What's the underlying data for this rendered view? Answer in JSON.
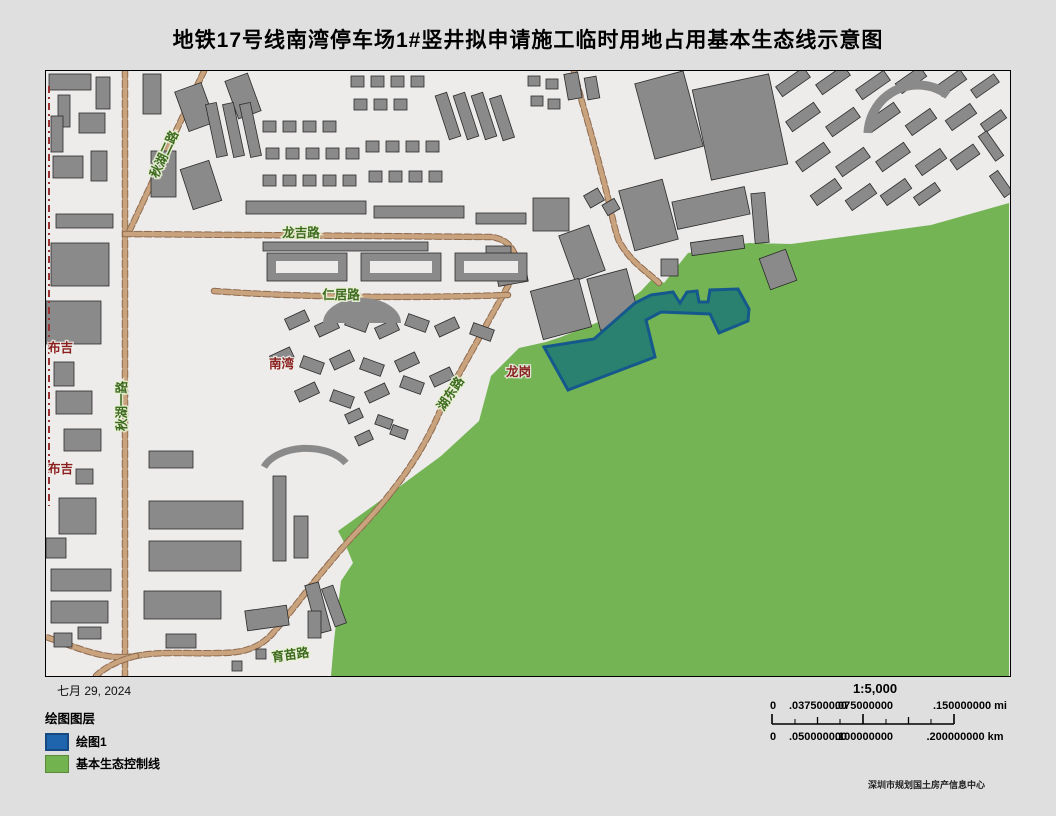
{
  "title": "地铁17号线南湾停车场1#竖井拟申请施工临时用地占用基本生态线示意图",
  "date_text": "七月 29, 2024",
  "attribution": "深圳市规划国土房产信息中心",
  "legend": {
    "title": "绘图图层",
    "items": [
      {
        "label": "绘图1",
        "color": "#1f65ae"
      },
      {
        "label": "基本生态控制线",
        "color": "#72b24f"
      }
    ]
  },
  "scalebar": {
    "ratio": "1:5,000",
    "mi_labels": [
      "0",
      ".037500000",
      ".075000000",
      ".150000000 mi"
    ],
    "km_labels": [
      "0",
      ".050000000",
      ".100000000",
      ".200000000 km"
    ]
  },
  "colors": {
    "page_bg": "#dfdfdf",
    "map_bg": "#edeceb",
    "eco_green": "#74b455",
    "plot_fill": "#2a8170",
    "plot_border": "#15588c",
    "road": "#c9a37d",
    "road_casing": "#8f6a4e",
    "building": "#8a8a8a",
    "building_outline": "#2b2b2b",
    "boundary_red": "#9a3434",
    "road_label_green": "#3c6b1d",
    "place_label_red": "#8b1f1f"
  },
  "map": {
    "labels": {
      "qiuhu2": "秋湖二路",
      "longji": "龙吉路",
      "renju": "仁居路",
      "qiuhu1": "秋湖一路",
      "hudong": "湖东路",
      "yumiao": "育苗路",
      "buji_north": "布吉",
      "buji_south": "布吉",
      "nanwan": "南湾",
      "longgang": "龙岗"
    },
    "green_polygon": "963,132 885,154 745,173 703,172 655,180 642,182 618,212 608,206 595,220 555,250 515,266 500,271 473,277 460,290 445,305 433,350 395,385 338,427 292,460 300,475 307,492 295,510 288,570 285,605 963,605",
    "plot_polygon": "498,276 548,268 589,232 605,224 627,221 634,232 641,221 651,220 653,231 662,231 664,219 692,218 703,238 702,250 673,262 664,243 615,241 600,249 609,286 522,319",
    "boundary_line": "M3,15 L3,435",
    "roads": [
      "M79,0 L79,605",
      "M158,0 L82,163",
      "M79,163 L445,166 C463,168 470,180 472,197",
      "M472,197 L398,330 C380,378 350,420 307,465 C275,500 250,535 227,562 C213,578 195,582 175,582 C140,583 115,580 90,585 C60,590 35,578 0,566",
      "M90,585 C70,590 57,598 50,605",
      "M168,220 C260,227 380,227 462,224",
      "M528,0 C535,30 545,60 555,100 C565,135 567,155 573,170 C585,192 603,202 613,212"
    ],
    "buildings": [
      [
        3,
        3,
        42,
        16,
        0
      ],
      [
        12,
        24,
        12,
        32,
        0
      ],
      [
        50,
        6,
        14,
        32,
        0
      ],
      [
        5,
        45,
        12,
        36,
        0
      ],
      [
        33,
        42,
        26,
        20,
        0
      ],
      [
        7,
        85,
        30,
        22,
        0
      ],
      [
        45,
        80,
        16,
        30,
        0
      ],
      [
        10,
        143,
        57,
        14,
        0
      ],
      [
        5,
        172,
        58,
        43,
        0
      ],
      [
        0,
        230,
        55,
        43,
        0
      ],
      [
        8,
        291,
        20,
        24,
        0
      ],
      [
        10,
        320,
        36,
        23,
        0
      ],
      [
        18,
        358,
        37,
        22,
        0
      ],
      [
        30,
        398,
        17,
        15,
        0
      ],
      [
        13,
        427,
        37,
        36,
        0
      ],
      [
        0,
        467,
        20,
        20,
        0
      ],
      [
        5,
        498,
        60,
        22,
        0
      ],
      [
        5,
        530,
        57,
        22,
        0
      ],
      [
        32,
        556,
        23,
        12,
        0
      ],
      [
        8,
        562,
        18,
        14,
        0
      ],
      [
        103,
        380,
        44,
        17,
        0
      ],
      [
        103,
        430,
        94,
        28,
        0
      ],
      [
        103,
        470,
        92,
        30,
        0
      ],
      [
        98,
        520,
        77,
        28,
        0
      ],
      [
        120,
        563,
        30,
        14,
        0
      ],
      [
        227,
        405,
        13,
        85,
        0
      ],
      [
        248,
        445,
        14,
        42,
        0
      ],
      [
        200,
        537,
        42,
        20,
        -8
      ],
      [
        265,
        512,
        14,
        50,
        -15
      ],
      [
        282,
        515,
        12,
        40,
        -20
      ],
      [
        262,
        540,
        13,
        27,
        0
      ],
      [
        210,
        578,
        10,
        10,
        0
      ],
      [
        186,
        590,
        10,
        10,
        0
      ],
      [
        97,
        3,
        18,
        40,
        0
      ],
      [
        135,
        15,
        28,
        42,
        -20
      ],
      [
        185,
        5,
        24,
        40,
        -20
      ],
      [
        105,
        80,
        25,
        46,
        0
      ],
      [
        140,
        93,
        30,
        42,
        -18
      ],
      [
        165,
        32,
        11,
        54,
        -12
      ],
      [
        182,
        32,
        11,
        54,
        -12
      ],
      [
        199,
        32,
        11,
        54,
        -12
      ],
      [
        217,
        50,
        13,
        11,
        0
      ],
      [
        237,
        50,
        13,
        11,
        0
      ],
      [
        257,
        50,
        13,
        11,
        0
      ],
      [
        277,
        50,
        13,
        11,
        0
      ],
      [
        220,
        77,
        13,
        11,
        0
      ],
      [
        240,
        77,
        13,
        11,
        0
      ],
      [
        260,
        77,
        13,
        11,
        0
      ],
      [
        280,
        77,
        13,
        11,
        0
      ],
      [
        300,
        77,
        13,
        11,
        0
      ],
      [
        217,
        104,
        13,
        11,
        0
      ],
      [
        237,
        104,
        13,
        11,
        0
      ],
      [
        257,
        104,
        13,
        11,
        0
      ],
      [
        277,
        104,
        13,
        11,
        0
      ],
      [
        297,
        104,
        13,
        11,
        0
      ],
      [
        320,
        70,
        13,
        11,
        0
      ],
      [
        340,
        70,
        13,
        11,
        0
      ],
      [
        360,
        70,
        13,
        11,
        0
      ],
      [
        380,
        70,
        13,
        11,
        0
      ],
      [
        323,
        100,
        13,
        11,
        0
      ],
      [
        343,
        100,
        13,
        11,
        0
      ],
      [
        363,
        100,
        13,
        11,
        0
      ],
      [
        383,
        100,
        13,
        11,
        0
      ],
      [
        396,
        22,
        12,
        46,
        -18
      ],
      [
        414,
        22,
        12,
        46,
        -18
      ],
      [
        432,
        22,
        12,
        46,
        -18
      ],
      [
        450,
        25,
        12,
        44,
        -18
      ],
      [
        482,
        5,
        12,
        10,
        0
      ],
      [
        500,
        8,
        12,
        10,
        0
      ],
      [
        485,
        25,
        12,
        10,
        0
      ],
      [
        502,
        28,
        12,
        10,
        0
      ],
      [
        520,
        2,
        14,
        26,
        -10
      ],
      [
        540,
        6,
        12,
        22,
        -10
      ],
      [
        305,
        5,
        13,
        11,
        0
      ],
      [
        325,
        5,
        13,
        11,
        0
      ],
      [
        345,
        5,
        13,
        11,
        0
      ],
      [
        365,
        5,
        13,
        11,
        0
      ],
      [
        308,
        28,
        13,
        11,
        0
      ],
      [
        328,
        28,
        13,
        11,
        0
      ],
      [
        348,
        28,
        13,
        11,
        0
      ],
      [
        200,
        130,
        120,
        13,
        0
      ],
      [
        328,
        135,
        90,
        12,
        0
      ],
      [
        430,
        142,
        50,
        11,
        0
      ],
      [
        217,
        171,
        165,
        9,
        0
      ],
      [
        240,
        243,
        22,
        12,
        -25
      ],
      [
        270,
        250,
        22,
        12,
        -25
      ],
      [
        300,
        246,
        22,
        12,
        20
      ],
      [
        330,
        252,
        22,
        12,
        -25
      ],
      [
        360,
        246,
        22,
        12,
        20
      ],
      [
        390,
        250,
        22,
        12,
        -25
      ],
      [
        425,
        255,
        22,
        12,
        20
      ],
      [
        225,
        280,
        22,
        12,
        -25
      ],
      [
        255,
        288,
        22,
        12,
        20
      ],
      [
        285,
        283,
        22,
        12,
        -25
      ],
      [
        315,
        290,
        22,
        12,
        20
      ],
      [
        350,
        285,
        22,
        12,
        -25
      ],
      [
        250,
        315,
        22,
        12,
        -25
      ],
      [
        285,
        322,
        22,
        12,
        20
      ],
      [
        320,
        316,
        22,
        12,
        -25
      ],
      [
        355,
        308,
        22,
        12,
        20
      ],
      [
        385,
        300,
        22,
        12,
        -25
      ],
      [
        300,
        340,
        16,
        10,
        -25
      ],
      [
        330,
        346,
        16,
        10,
        20
      ],
      [
        310,
        362,
        16,
        10,
        -25
      ],
      [
        345,
        356,
        16,
        10,
        20
      ],
      [
        598,
        5,
        50,
        78,
        -15
      ],
      [
        655,
        10,
        78,
        92,
        -12
      ],
      [
        580,
        113,
        45,
        62,
        -15
      ],
      [
        628,
        123,
        74,
        28,
        -12
      ],
      [
        645,
        168,
        53,
        13,
        -8
      ],
      [
        707,
        122,
        14,
        50,
        -5
      ],
      [
        718,
        182,
        28,
        33,
        -20
      ],
      [
        615,
        188,
        17,
        17,
        0
      ],
      [
        487,
        127,
        36,
        33,
        0
      ],
      [
        520,
        158,
        32,
        48,
        -20
      ],
      [
        540,
        120,
        16,
        14,
        -30
      ],
      [
        558,
        130,
        14,
        12,
        -30
      ],
      [
        440,
        175,
        25,
        25,
        0
      ],
      [
        490,
        213,
        50,
        50,
        -15
      ],
      [
        547,
        202,
        41,
        53,
        -15
      ],
      [
        450,
        185,
        30,
        28,
        -10
      ],
      [
        730,
        5,
        34,
        12,
        -35
      ],
      [
        770,
        3,
        34,
        12,
        -35
      ],
      [
        810,
        8,
        34,
        12,
        -35
      ],
      [
        850,
        3,
        30,
        12,
        -35
      ],
      [
        890,
        6,
        30,
        12,
        -35
      ],
      [
        925,
        10,
        28,
        10,
        -35
      ],
      [
        740,
        40,
        34,
        12,
        -35
      ],
      [
        780,
        45,
        34,
        12,
        -35
      ],
      [
        820,
        40,
        34,
        12,
        -35
      ],
      [
        860,
        45,
        30,
        12,
        -35
      ],
      [
        900,
        40,
        30,
        12,
        -35
      ],
      [
        935,
        45,
        25,
        10,
        -35
      ],
      [
        750,
        80,
        34,
        12,
        -35
      ],
      [
        790,
        85,
        34,
        12,
        -35
      ],
      [
        830,
        80,
        34,
        12,
        -35
      ],
      [
        870,
        85,
        30,
        12,
        -35
      ],
      [
        905,
        80,
        28,
        12,
        -35
      ],
      [
        765,
        115,
        30,
        12,
        -35
      ],
      [
        800,
        120,
        30,
        12,
        -35
      ],
      [
        835,
        115,
        30,
        12,
        -35
      ],
      [
        868,
        118,
        26,
        10,
        -35
      ],
      [
        940,
        60,
        10,
        30,
        -35
      ],
      [
        950,
        100,
        10,
        26,
        -35
      ]
    ],
    "courtyards": [
      [
        221,
        182,
        80,
        28
      ],
      [
        315,
        182,
        80,
        28
      ],
      [
        409,
        182,
        72,
        28
      ]
    ],
    "extra_paths": [
      {
        "d": "M277,252 A39,25 0 0 1 355,252 Z",
        "fill": "building"
      },
      {
        "d": "M218,396 A45,28 0 0 1 300,392",
        "stroke": "building",
        "w": 7
      },
      {
        "d": "M822,62 A50,50 0 0 1 902,24",
        "stroke": "building",
        "w": 9
      }
    ]
  }
}
